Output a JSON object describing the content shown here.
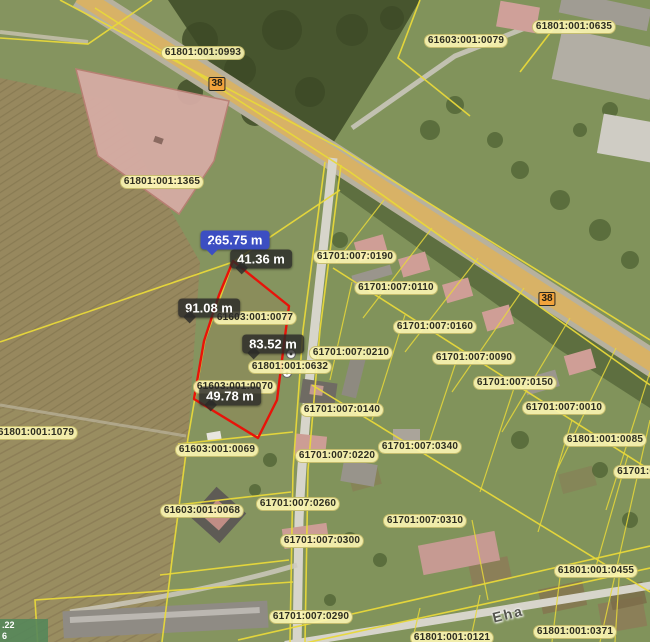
{
  "map": {
    "colors": {
      "parcel_line": "#e8d83a",
      "highlight_outline": "#e81309",
      "parcel_label_bg": "rgba(252,246,178,0.9)",
      "parcel_label_text": "#2d2d20",
      "measure_bg": "rgba(42,42,40,0.82)",
      "measure_total_bg": "#3c4ec2",
      "measure_text": "#ffffff",
      "road_badge_bg": "#f2a33c",
      "coord_box_bg": "rgba(85,135,90,0.9)"
    },
    "parcel_labels": [
      {
        "label": "61801:001:0993",
        "x": 203,
        "y": 53
      },
      {
        "label": "61603:001:0079",
        "x": 466,
        "y": 41
      },
      {
        "label": "61801:001:0635",
        "x": 574,
        "y": 27
      },
      {
        "label": "61801:001:1365",
        "x": 162,
        "y": 182
      },
      {
        "label": "61701:007:0190",
        "x": 355,
        "y": 257
      },
      {
        "label": "61701:007:0110",
        "x": 396,
        "y": 288
      },
      {
        "label": "61701:007:0160",
        "x": 435,
        "y": 327
      },
      {
        "label": "61701:007:0090",
        "x": 474,
        "y": 358
      },
      {
        "label": "61701:007:0150",
        "x": 515,
        "y": 383
      },
      {
        "label": "61701:007:0010",
        "x": 564,
        "y": 408
      },
      {
        "label": "61801:001:0085",
        "x": 605,
        "y": 440
      },
      {
        "label": "61701:00",
        "x": 639,
        "y": 472
      },
      {
        "label": "61801:001:1079",
        "x": 36,
        "y": 433
      },
      {
        "label": "61603:001:0077",
        "x": 255,
        "y": 318
      },
      {
        "label": "61801:001:0632",
        "x": 290,
        "y": 367
      },
      {
        "label": "61603:001:0070",
        "x": 235,
        "y": 387
      },
      {
        "label": "61701:007:0210",
        "x": 351,
        "y": 353
      },
      {
        "label": "61701:007:0140",
        "x": 342,
        "y": 410
      },
      {
        "label": "61701:007:0340",
        "x": 420,
        "y": 447
      },
      {
        "label": "61603:001:0069",
        "x": 217,
        "y": 450
      },
      {
        "label": "61701:007:0220",
        "x": 337,
        "y": 456
      },
      {
        "label": "61603:001:0068",
        "x": 202,
        "y": 511
      },
      {
        "label": "61701:007:0260",
        "x": 298,
        "y": 504
      },
      {
        "label": "61701:007:0310",
        "x": 425,
        "y": 521
      },
      {
        "label": "61701:007:0300",
        "x": 322,
        "y": 541
      },
      {
        "label": "61701:007:0290",
        "x": 311,
        "y": 617
      },
      {
        "label": "61801:001:0455",
        "x": 596,
        "y": 571
      },
      {
        "label": "61801:001:0371",
        "x": 575,
        "y": 632
      },
      {
        "label": "61801:001:0121",
        "x": 452,
        "y": 638
      }
    ],
    "measurements": [
      {
        "label": "265.75 m",
        "x": 235,
        "y": 240,
        "total": true
      },
      {
        "label": "41.36 m",
        "x": 261,
        "y": 259,
        "total": false
      },
      {
        "label": "91.08 m",
        "x": 209,
        "y": 308,
        "total": false
      },
      {
        "label": "83.52 m",
        "x": 273,
        "y": 344,
        "total": false
      },
      {
        "label": "49.78 m",
        "x": 230,
        "y": 396,
        "total": false
      }
    ],
    "road_badges": [
      {
        "label": "38",
        "x": 217,
        "y": 84
      },
      {
        "label": "38",
        "x": 547,
        "y": 299
      }
    ],
    "street_labels": [
      {
        "label": "Eha",
        "x": 508,
        "y": 614,
        "angle": -14
      }
    ],
    "coordinate_overlay": {
      "lines": [
        ".22",
        "6"
      ]
    }
  }
}
